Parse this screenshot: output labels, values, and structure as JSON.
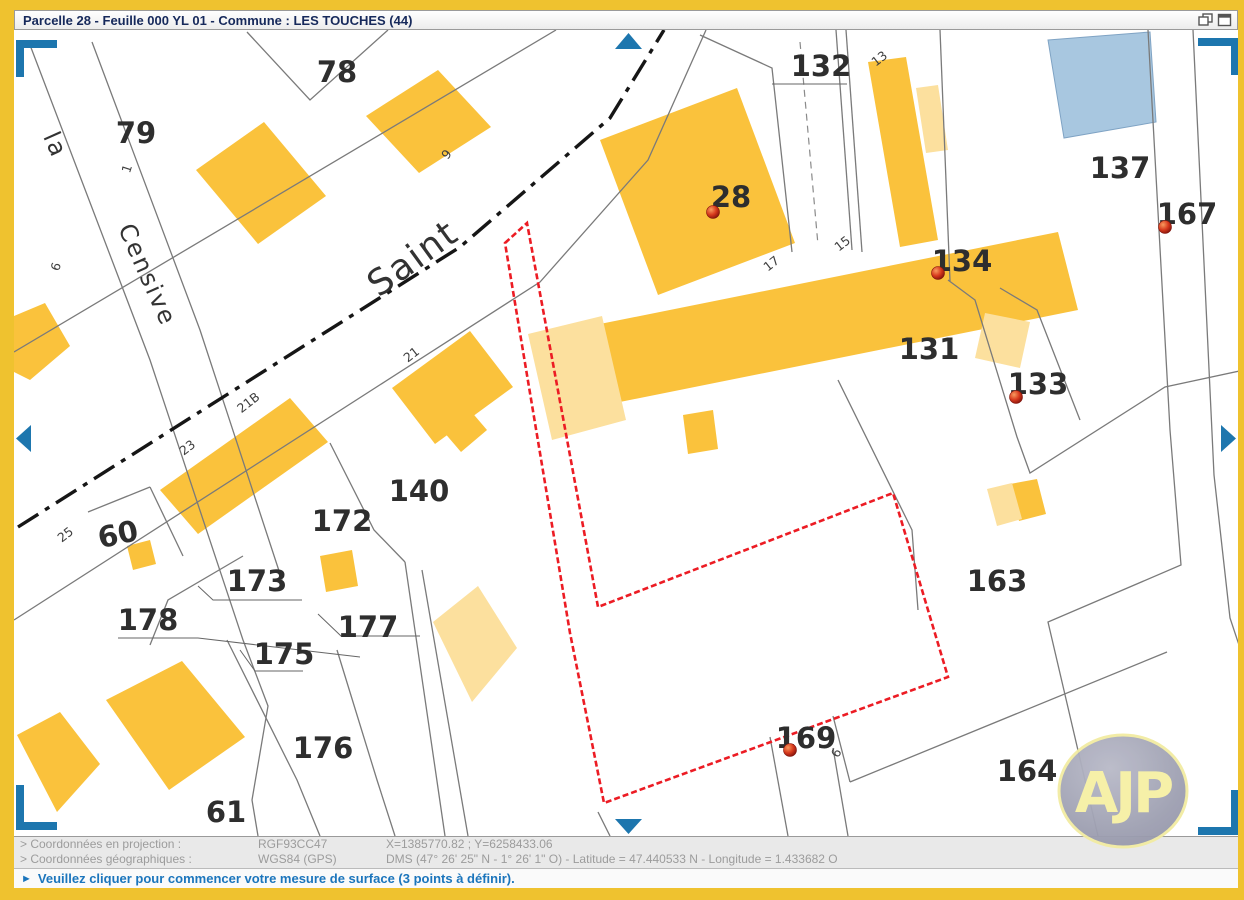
{
  "window": {
    "title": "Parcelle 28 - Feuille 000 YL 01 - Commune : LES TOUCHES (44)"
  },
  "map": {
    "selected_parcel": "28",
    "street_names": [
      {
        "text": "Saint",
        "x": 420,
        "y": 268,
        "rotate": -36,
        "size": 36
      },
      {
        "text": "la",
        "x": 48,
        "y": 148,
        "rotate": 66,
        "size": 24
      },
      {
        "text": "Censive",
        "x": 140,
        "y": 278,
        "rotate": 66,
        "size": 24
      }
    ],
    "parcel_labels": [
      {
        "text": "78",
        "x": 337,
        "y": 82
      },
      {
        "text": "79",
        "x": 136,
        "y": 143
      },
      {
        "text": "132",
        "x": 821,
        "y": 76
      },
      {
        "text": "28",
        "x": 731,
        "y": 207
      },
      {
        "text": "137",
        "x": 1120,
        "y": 178
      },
      {
        "text": "167",
        "x": 1187,
        "y": 224
      },
      {
        "text": "134",
        "x": 962,
        "y": 271
      },
      {
        "text": "131",
        "x": 929,
        "y": 359
      },
      {
        "text": "133",
        "x": 1038,
        "y": 394
      },
      {
        "text": "140",
        "x": 419,
        "y": 501
      },
      {
        "text": "172",
        "x": 342,
        "y": 531
      },
      {
        "text": "60",
        "x": 120,
        "y": 544,
        "rotate": -12
      },
      {
        "text": "173",
        "x": 257,
        "y": 591
      },
      {
        "text": "178",
        "x": 148,
        "y": 630
      },
      {
        "text": "177",
        "x": 368,
        "y": 637
      },
      {
        "text": "175",
        "x": 284,
        "y": 664
      },
      {
        "text": "176",
        "x": 323,
        "y": 758
      },
      {
        "text": "61",
        "x": 226,
        "y": 822
      },
      {
        "text": "163",
        "x": 997,
        "y": 591
      },
      {
        "text": "169",
        "x": 806,
        "y": 748
      },
      {
        "text": "164",
        "x": 1027,
        "y": 781
      }
    ],
    "small_labels": [
      {
        "text": "1",
        "x": 131,
        "y": 170,
        "rotate": -72
      },
      {
        "text": "6",
        "x": 60,
        "y": 268,
        "rotate": -72
      },
      {
        "text": "9",
        "x": 450,
        "y": 157,
        "rotate": -52
      },
      {
        "text": "21",
        "x": 414,
        "y": 358,
        "rotate": -38
      },
      {
        "text": "21B",
        "x": 251,
        "y": 406,
        "rotate": -38
      },
      {
        "text": "23",
        "x": 190,
        "y": 451,
        "rotate": -38
      },
      {
        "text": "25",
        "x": 68,
        "y": 538,
        "rotate": -38
      },
      {
        "text": "17",
        "x": 774,
        "y": 267,
        "rotate": -38
      },
      {
        "text": "15",
        "x": 845,
        "y": 247,
        "rotate": -38
      },
      {
        "text": "13",
        "x": 882,
        "y": 62,
        "rotate": -38
      },
      {
        "text": "6",
        "x": 840,
        "y": 755,
        "rotate": -60
      }
    ],
    "markers": [
      {
        "parcel": "28",
        "x": 713,
        "y": 212
      },
      {
        "parcel": "134",
        "x": 938,
        "y": 273
      },
      {
        "parcel": "167",
        "x": 1165,
        "y": 227
      },
      {
        "parcel": "133",
        "x": 1016,
        "y": 397
      },
      {
        "parcel": "169",
        "x": 790,
        "y": 750
      }
    ]
  },
  "statusbar": {
    "rows": [
      {
        "label": "> Coordonnées en projection :",
        "system": "RGF93CC47",
        "values": "X=1385770.82 ; Y=6258433.06"
      },
      {
        "label": "> Coordonnées géographiques :",
        "system": "WGS84 (GPS)",
        "values": "DMS (47° 26' 25\" N - 1° 26' 1\" O) - Latitude = 47.440533 N - Longitude = 1.433682 O"
      }
    ]
  },
  "message_bar": {
    "icon": "play-arrow-icon",
    "arrow": "►",
    "text": "Veuillez cliquer pour commencer votre mesure de surface (3 points à définir)."
  },
  "logo": {
    "text": "AJP"
  },
  "colors": {
    "frame": "#EFC22F",
    "building": "#FAC23C",
    "building_light": "#FCE09E",
    "building_blue": "#A8C7E0",
    "parcel_line": "#7a7a7a",
    "selected_outline": "#EC1C24",
    "nav_arrow": "#1D76AE",
    "title_text": "#16295B",
    "message_text": "#1B75BC"
  }
}
